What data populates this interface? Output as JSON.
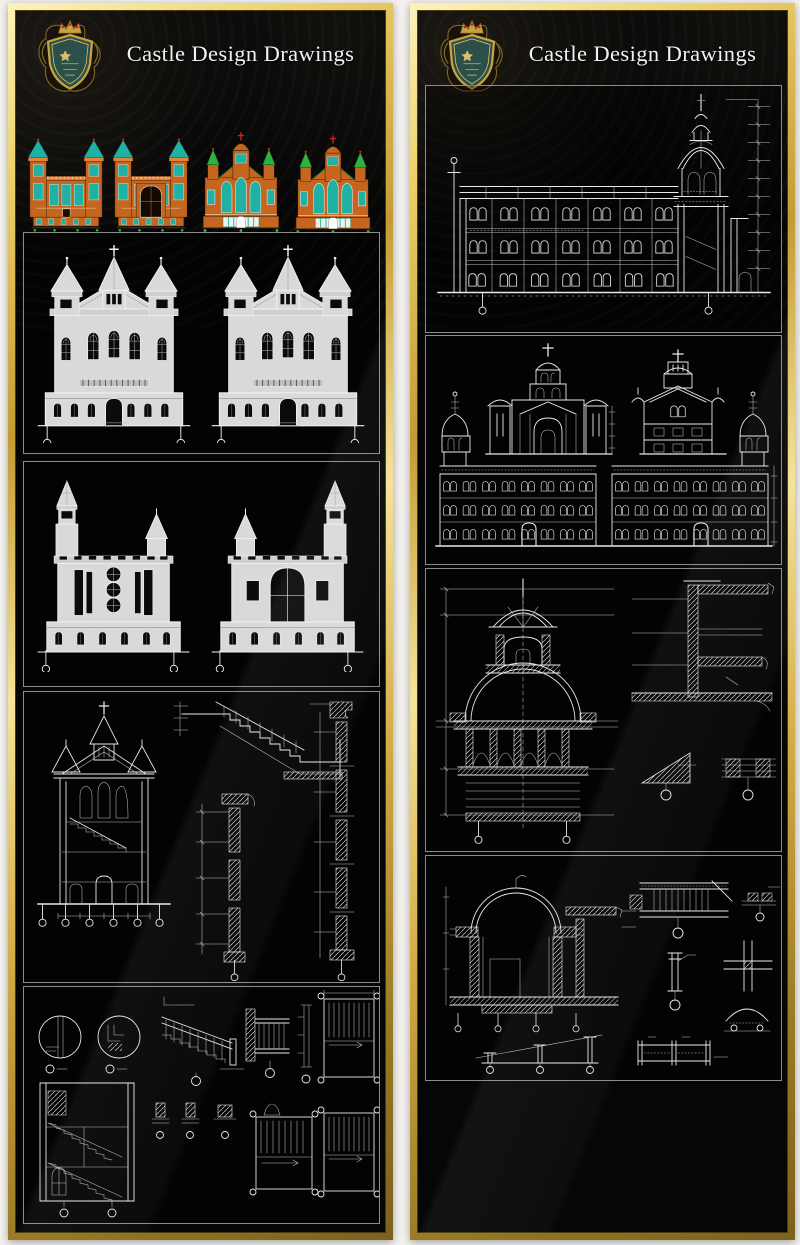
{
  "page": {
    "background": "#f3f2ee"
  },
  "logo": {
    "icon": "heraldic-shield-crest-icon"
  },
  "panels": [
    {
      "id": "left",
      "title": "Castle Design Drawings"
    },
    {
      "id": "right",
      "title": "Castle Design Drawings"
    }
  ],
  "colors": {
    "page_bg": "#f3f2ee",
    "panel_bg": "#060606",
    "line": "#e9e9e9",
    "fill_light": "#d9d9d9",
    "window_dark": "#0b0b0b",
    "section_border": "#8c8c8c",
    "title_text": "#f2f2f2",
    "gold_light": "#f8ecb4",
    "gold": "#d2a73e",
    "gold_dark": "#8a6a1f",
    "c_orange": "#c4661f",
    "c_teal": "#1fb1a3",
    "c_green": "#2db33c",
    "c_red": "#cf1f1f",
    "crest_teal": "#2c4f49",
    "crest_gold": "#c9a23f"
  }
}
